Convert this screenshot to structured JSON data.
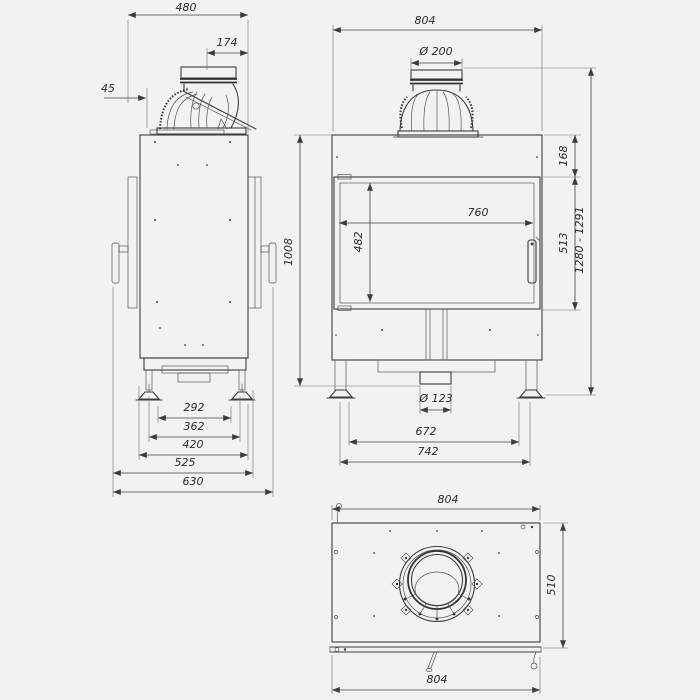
{
  "colors": {
    "background": "#f3f2f0",
    "line": "#3c3c3c",
    "text": "#2b2b2b"
  },
  "views": {
    "side": {
      "depth_total": "480",
      "flue_center_offset": "174",
      "top_offset": "45",
      "base_dims": [
        "292",
        "362",
        "420",
        "525",
        "630"
      ]
    },
    "front": {
      "width_total": "804",
      "flue_diameter": "Ø 200",
      "collar_to_door": "168",
      "glass_width": "760",
      "glass_height": "482",
      "door_height": "513",
      "overall_height": "1280 - 1291",
      "body_height": "1008",
      "inlet_diameter": "Ø 123",
      "feet_span": "672",
      "base_width": "742"
    },
    "top": {
      "width_top": "804",
      "depth": "510",
      "width_front": "804"
    }
  }
}
